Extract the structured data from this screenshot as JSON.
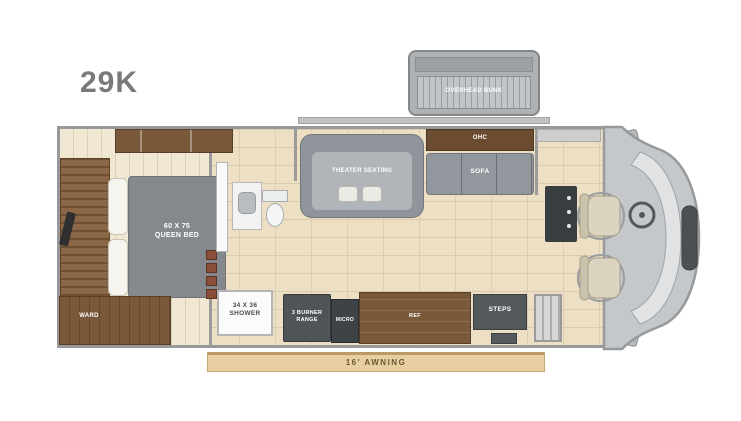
{
  "title": "29K",
  "overhead_bunk": {
    "label": "OVERHEAD BUNK"
  },
  "bedroom": {
    "bed_line1": "60 X 75",
    "bed_line2": "QUEEN BED",
    "wardrobe_label": "WARD"
  },
  "living_room": {
    "cabinet_label": "OHC",
    "theater_label": "THEATER SEATING",
    "sofa_label": "SOFA"
  },
  "bathroom": {
    "shower_line1": "34 X 36",
    "shower_line2": "SHOWER"
  },
  "kitchen": {
    "range_line1": "3 BURNER",
    "range_line2": "RANGE",
    "microwave_label": "MICRO",
    "fridge_label": "REF"
  },
  "entry": {
    "steps_label": "STEPS"
  },
  "exterior": {
    "awning_label": "16' AWNING"
  },
  "colors": {
    "wood": "#7a583a",
    "appliance": "#4e5458",
    "floor_tile": "#ecdfc4",
    "awning": "#e7cfa2",
    "title_gray": "#7a7a7a"
  }
}
